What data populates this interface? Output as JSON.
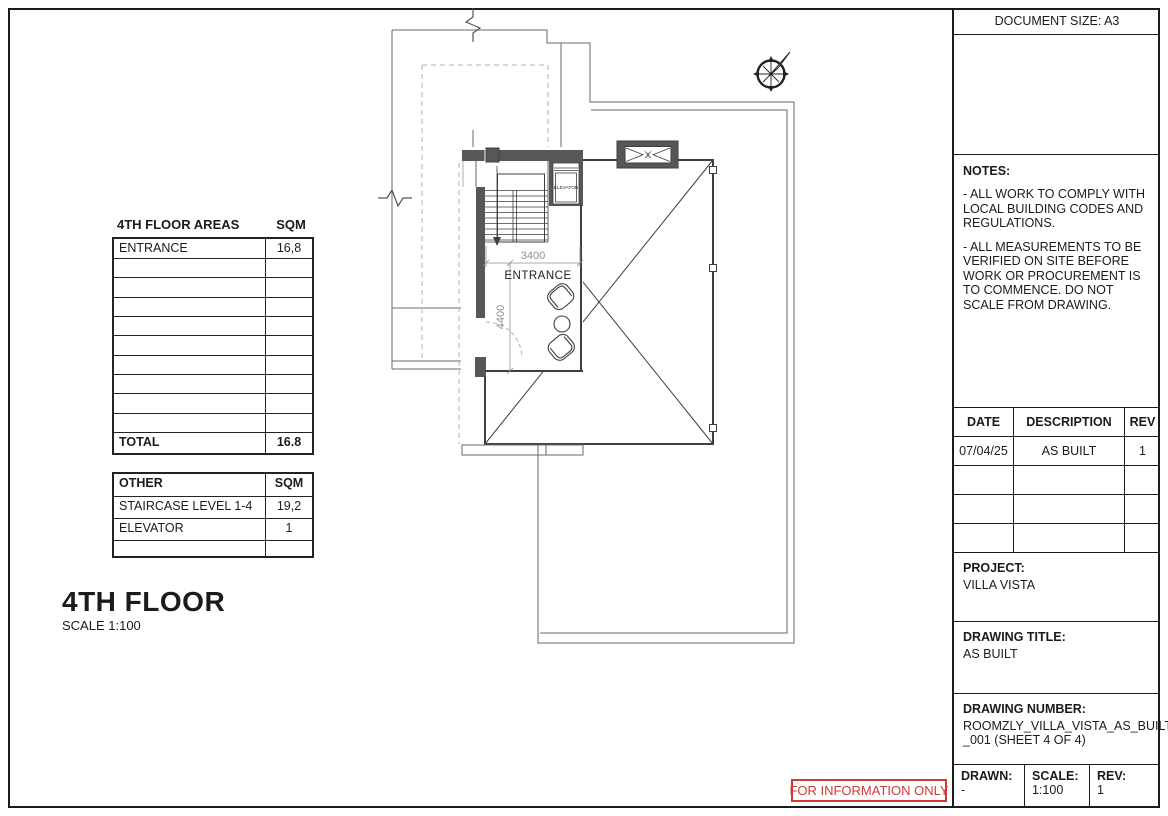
{
  "sheet": {
    "document_size_label": "DOCUMENT SIZE: A3"
  },
  "notes": {
    "title": "NOTES:",
    "items": [
      "- ALL WORK TO COMPLY WITH LOCAL BUILDING CODES AND REGULATIONS.",
      "- ALL MEASUREMENTS TO BE VERIFIED ON SITE BEFORE WORK OR PROCUREMENT IS TO COMMENCE. DO NOT SCALE FROM DRAWING."
    ]
  },
  "revision_table": {
    "headers": {
      "date": "DATE",
      "description": "DESCRIPTION",
      "rev": "REV"
    },
    "rows": [
      {
        "date": "07/04/25",
        "description": "AS BUILT",
        "rev": "1"
      }
    ],
    "empty_row_count": 3
  },
  "project": {
    "label": "PROJECT:",
    "name": "VILLA VISTA"
  },
  "drawing_title": {
    "label": "DRAWING TITLE:",
    "value": "AS BUILT"
  },
  "drawing_number": {
    "label": "DRAWING NUMBER:",
    "value_lines": [
      "ROOMZLY_VILLA_VISTA_AS_BUILT",
      "_001 (SHEET 4 OF 4)"
    ]
  },
  "title_footer": {
    "drawn_label": "DRAWN:",
    "drawn_value": "-",
    "scale_label": "SCALE:",
    "scale_value": "1:100",
    "rev_label": "REV:",
    "rev_value": "1"
  },
  "areas_table": {
    "title": "4TH FLOOR AREAS",
    "unit_header": "SQM",
    "rows": [
      {
        "name": "ENTRANCE",
        "sqm": "16,8"
      }
    ],
    "empty_row_count": 9,
    "total_label": "TOTAL",
    "total_value": "16.8"
  },
  "other_table": {
    "title": "OTHER",
    "unit_header": "SQM",
    "rows": [
      {
        "name": "STAIRCASE LEVEL 1-4",
        "sqm": "19,2"
      },
      {
        "name": "ELEVATOR",
        "sqm": "1"
      }
    ],
    "empty_row_count": 1
  },
  "floor_title": {
    "name": "4TH FLOOR",
    "scale": "SCALE 1:100"
  },
  "stamp": {
    "text": "FOR INFORMATION ONLY",
    "color": "#cc3b36"
  },
  "plan": {
    "labels": {
      "entrance": "ENTRANCE",
      "elevator": "ELEVATOR"
    },
    "dimensions": {
      "stair_width": "3400",
      "entrance_depth": "4400"
    }
  },
  "colors": {
    "wall_fill": "#575757",
    "line": "#3f3f3f",
    "dim_gray": "#8f8f8f",
    "stamp_red": "#cc3b36"
  }
}
